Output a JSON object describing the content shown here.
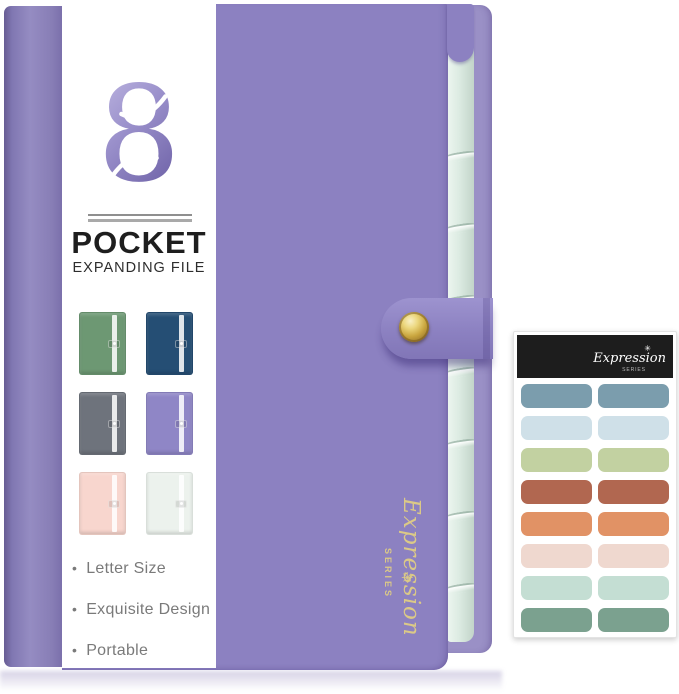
{
  "badge": {
    "number": "8",
    "title": "POCKET",
    "subtitle": "EXPANDING FILE",
    "logo_gradient": [
      "#c6bfe6",
      "#9a90cb",
      "#6f63a8"
    ]
  },
  "features": [
    "Letter Size",
    "Exquisite Design",
    "Portable"
  ],
  "cover_brand": {
    "script": "Expression",
    "series": "SERIES",
    "star_icon": "✳",
    "color": "#dbc987"
  },
  "folder": {
    "cover_color": "#8c81c1",
    "spine_dark": "#675c93",
    "spine_light": "#958cc2",
    "back_color": "#9a90c6",
    "pocket_color": "#dcebe2",
    "pocket_count": 8,
    "snap_gold": "#c9a53e"
  },
  "swatches": [
    {
      "name": "green",
      "color": "#6d9873"
    },
    {
      "name": "navy",
      "color": "#254e74"
    },
    {
      "name": "gray",
      "color": "#6e737c"
    },
    {
      "name": "purple",
      "color": "#8f86c6"
    },
    {
      "name": "pink",
      "color": "#f8d6ce"
    },
    {
      "name": "mint",
      "color": "#ecf2ed"
    }
  ],
  "sticker_sheet": {
    "script": "Expression",
    "series": "SERIES",
    "star_icon": "✳",
    "header_color": "#1d1d1d",
    "row_colors": [
      "#7b9dad",
      "#cfe0e8",
      "#c2d1a1",
      "#b16750",
      "#e19265",
      "#efd8cf",
      "#c4ded3",
      "#7ba18f"
    ]
  }
}
